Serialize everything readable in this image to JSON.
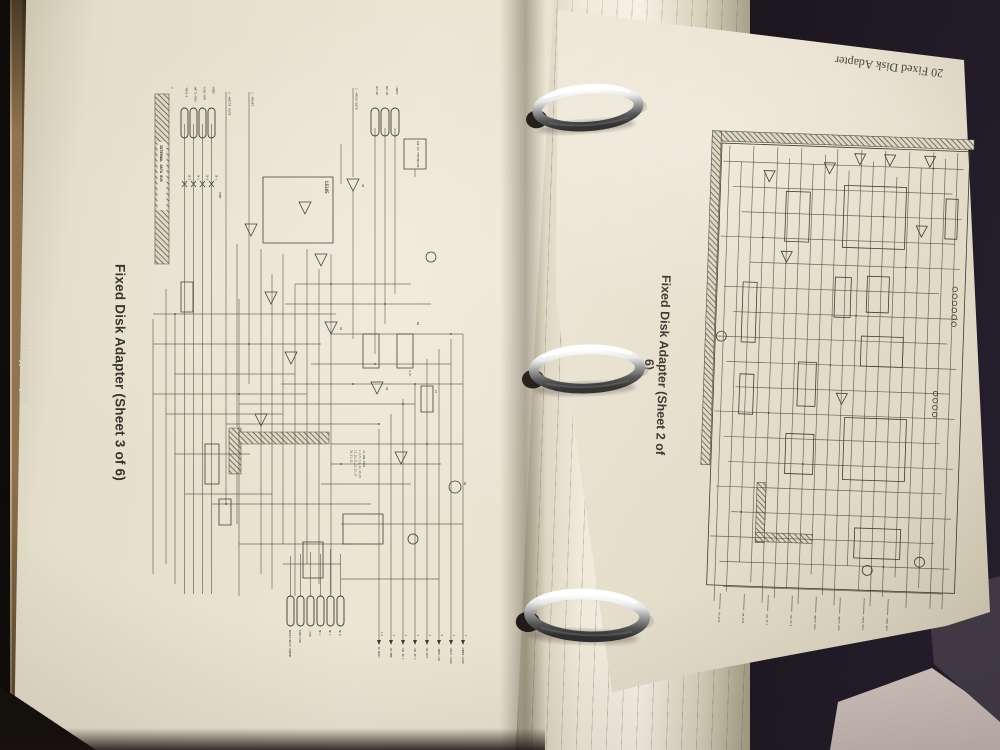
{
  "scene": {
    "background_color": "#181316",
    "page_color": "#ebe5d4",
    "ink_color": "#464036",
    "ring_color": "#c9c9c9",
    "cover_color": "#453c4a",
    "spine_color": "#8f734e"
  },
  "spine": {
    "label": "Miscellaneous"
  },
  "left_page": {
    "title": "Fixed Disk Adapter (Sheet 3 of 6)",
    "schematic": {
      "bus_label": "INTERNAL DATA BUS",
      "input_signals": [
        "-READY",
        "-DISK COMP",
        "-WRITE FAULT",
        "-TRACK 0"
      ],
      "input_pin_refs": [
        "28-1",
        "28-8",
        "28-3",
        "28-5"
      ],
      "control_signals": [
        "2 —WRITE GATE",
        "1 —RESET",
        "2 —READ GATE"
      ],
      "aux_signals": [
        "+INDEX",
        "DRV SEL",
        "SEL RDY"
      ],
      "term_label": "A10 SIP TERMINATION",
      "term_short": "TERM",
      "ic_label": "LS165",
      "refs": {
        "r4": "R4",
        "r4_value": "4.7K",
        "c3": "C3",
        "q6": "Q6",
        "gate": "04",
        "sheet": "2"
      },
      "output_connectors": [
        "HD 0",
        "HD 1",
        "HD 2",
        "-STEP",
        "DIRECTION",
        "REDUCE WRITE CURRENT"
      ],
      "output_signals": [
        "+POWER CLOCK",
        "-DELAY CLOCK",
        "-10MHZ CLK",
        "-RD GATE",
        "-SEL DR 2",
        "-SEL DR 1",
        "-AM ENBL",
        "AM RESET"
      ],
      "output_pins": [
        "2",
        "2",
        "6",
        "5",
        "5",
        "5",
        "2",
        "3,6"
      ],
      "gnd_note": [
        "J1 GND PINS",
        "1,3,5,7,9,11,13,15",
        "17,19,21,23,25,27",
        "29,31,33"
      ]
    }
  },
  "right_page": {
    "header": "20 Fixed Disk Adapter",
    "title": "Fixed Disk Adapter (Sheet 2 of 6)",
    "schematic": {
      "edge_signals": [
        "-READ DATA",
        "+READ DATA",
        "-WRITE DATA",
        "+WRITE DATA",
        "-SEL HD 0",
        "-SEL HD 1",
        "-WR GATE",
        "-RD GATE"
      ]
    }
  }
}
